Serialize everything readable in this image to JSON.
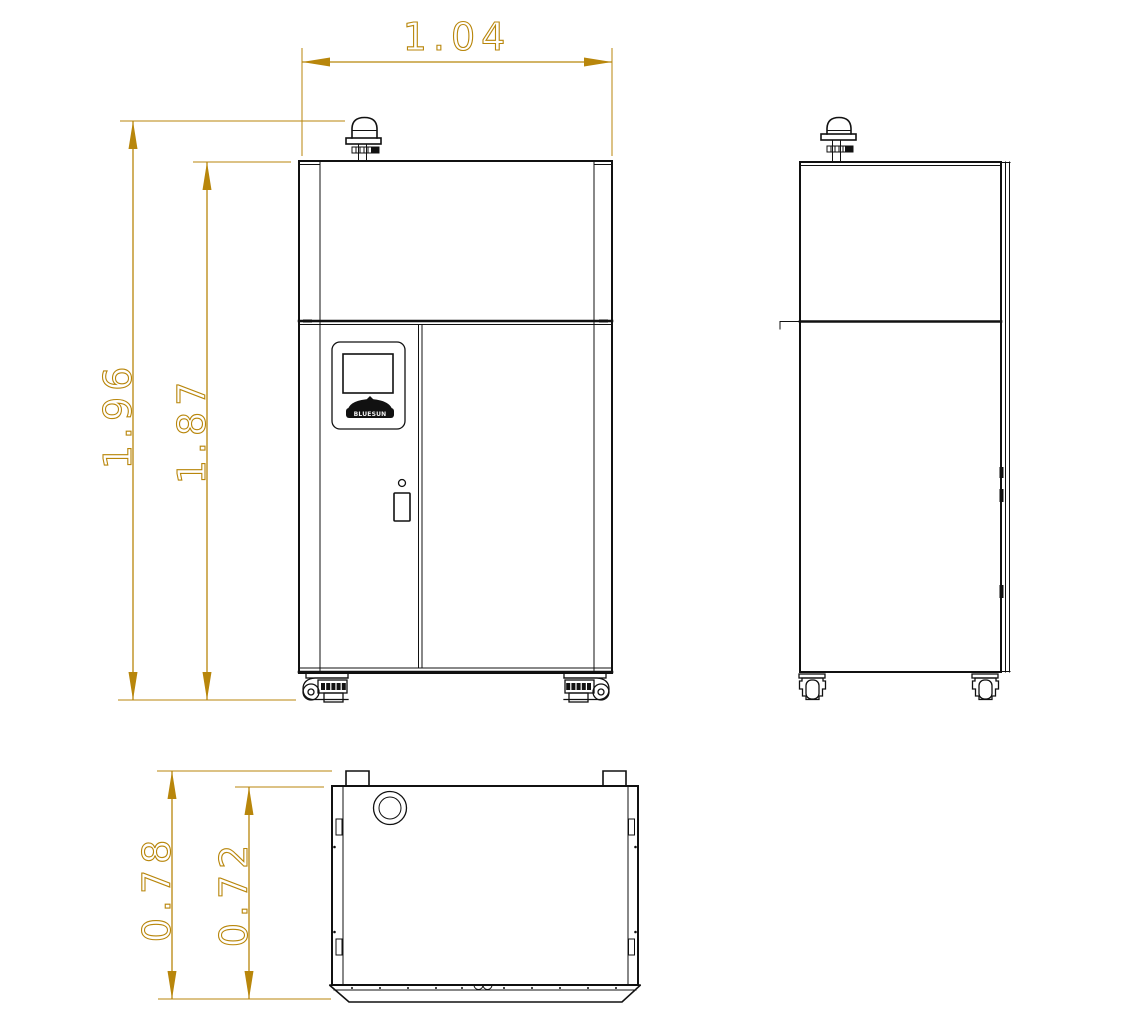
{
  "drawing": {
    "colors": {
      "dimension_gold": "#B8860B",
      "outline_black": "#111111",
      "background": "#ffffff"
    },
    "dimensions": {
      "front_width": "1.04",
      "total_height": "1.96",
      "body_height": "1.87",
      "total_depth": "0.78",
      "body_depth": "0.72"
    },
    "logo_text": "BLUESUN"
  }
}
